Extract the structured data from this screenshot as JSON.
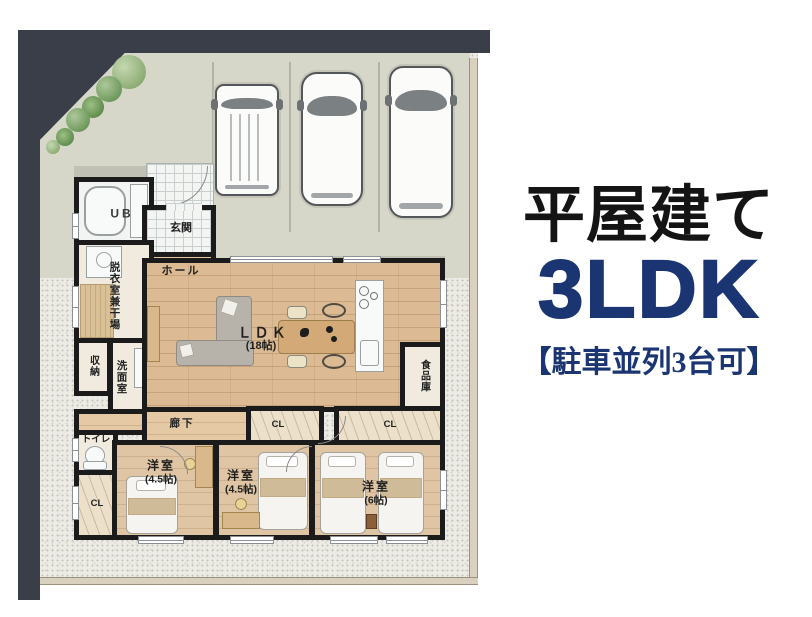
{
  "header": {
    "building_type": "平屋建て",
    "layout": "3LDK",
    "parking_note": "【駐車並列3台可】"
  },
  "floorplan": {
    "rooms": {
      "unit_bath": "UB",
      "entrance": "玄関",
      "hall": "ホール",
      "dressing_room": "脱衣室兼干場",
      "storage": "収納",
      "washroom": "洗面室",
      "toilet": "トイレ",
      "closet": "CL",
      "corridor": "廊下",
      "ldk": "ＬＤＫ",
      "ldk_size": "(18帖)",
      "pantry": "食品庫",
      "bedroom": "洋室",
      "bedroom_small_size": "(4.5帖)",
      "bedroom_large_size": "(6帖)"
    },
    "counts": {
      "cars": 3
    }
  },
  "colors": {
    "accent_navy": "#1a3572",
    "title_black": "#141414",
    "road": "#3a3e48",
    "concrete": "#d7d7c9",
    "wall": "#1b1b1b",
    "wood_floor": "#dcba93"
  }
}
